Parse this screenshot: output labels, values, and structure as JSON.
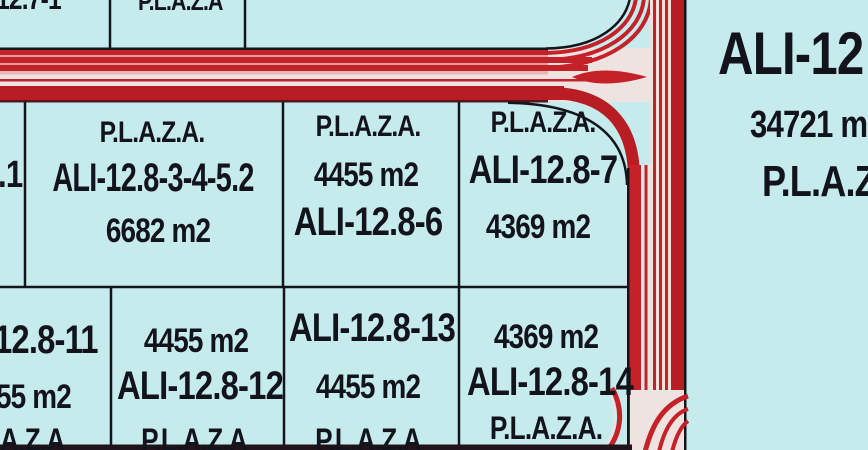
{
  "map": {
    "type": "cadastral plan with red roads on cyan background",
    "colors": {
      "background": "#c6ebed",
      "road_red": "#c42128",
      "road_dark_red": "#b91d24",
      "stripe_pink": "#e39c9c",
      "pale_median": "#eee3e0",
      "boundary_line": "#14141c"
    }
  },
  "parcels": {
    "top_left": {
      "id": "12.7-1"
    },
    "top_center": {
      "plaza": "P.L.A.Z.A"
    },
    "right_large": {
      "id": "ALI-12",
      "area": "34721 m2",
      "plaza": "P.L.A.Z.A."
    },
    "mid_left_partial": {
      "id": ".1"
    },
    "p3452": {
      "plaza": "P.L.A.Z.A.",
      "id": "ALI-12.8-3-4-5.2",
      "area": "6682 m2"
    },
    "p6": {
      "plaza": "P.L.A.Z.A.",
      "area": "4455 m2",
      "id": "ALI-12.8-6"
    },
    "p7": {
      "plaza": "P.L.A.Z.A.",
      "id": "ALI-12.8-7",
      "area": "4369 m2"
    },
    "p11": {
      "id": "12.8-11",
      "area": "55 m2",
      "plaza": "A.Z.A"
    },
    "p12": {
      "area": "4455 m2",
      "id": "ALI-12.8-12",
      "plaza": "P.L.A.Z.A"
    },
    "p13": {
      "id": "ALI-12.8-13",
      "area": "4455 m2",
      "plaza": "P.L.A.Z.A"
    },
    "p14": {
      "area": "4369 m2",
      "id": "ALI-12.8-14",
      "plaza": "P.L.A.Z.A."
    }
  }
}
